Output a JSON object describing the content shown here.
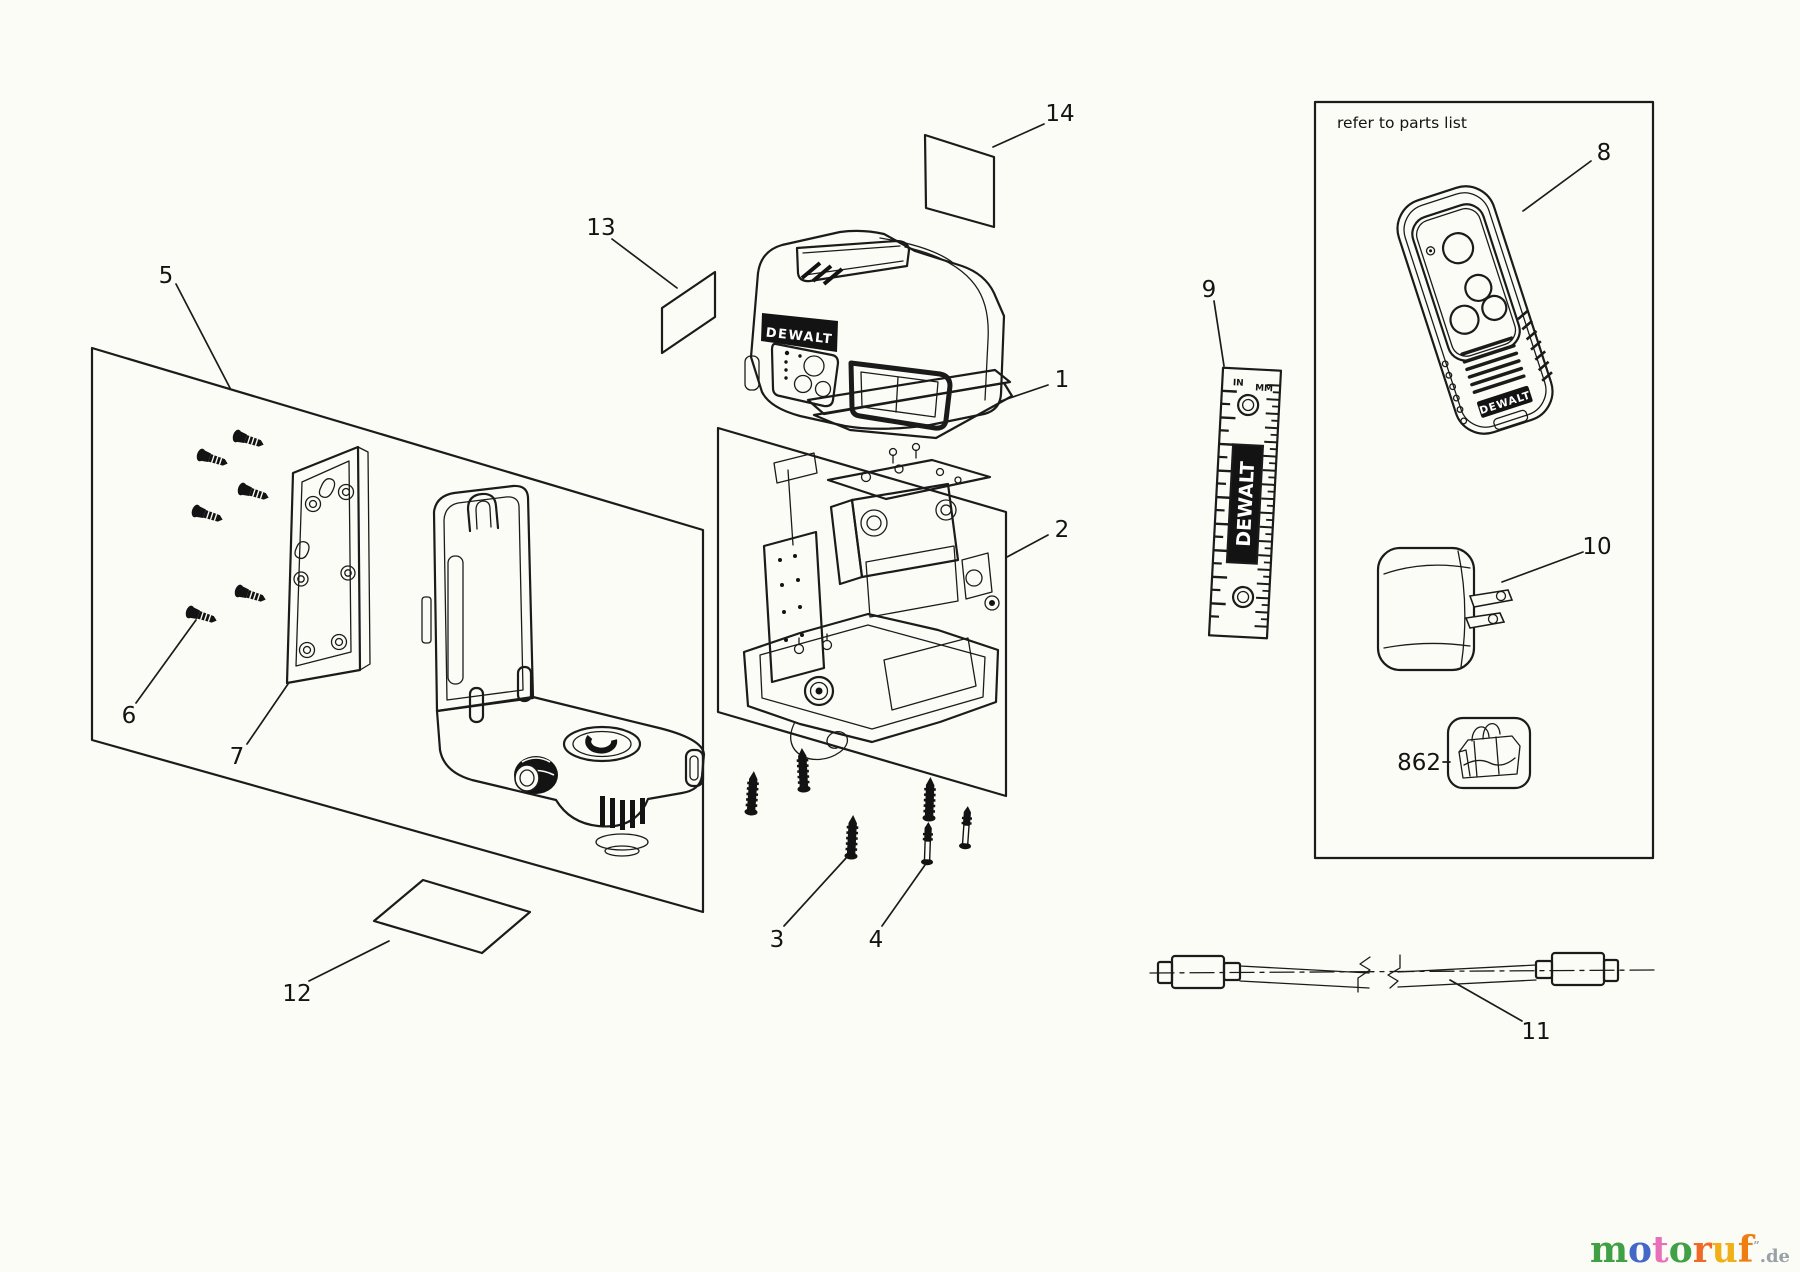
{
  "canvas": {
    "width": 1800,
    "height": 1272,
    "background": "#fcfcf6",
    "line_color": "#1b1b1b"
  },
  "brand": {
    "name": "DEWALT"
  },
  "parts_box": {
    "note": "refer to parts list"
  },
  "ruler": {
    "unit_left": "IN",
    "unit_right": "MM"
  },
  "callouts": {
    "c1": {
      "label": "1"
    },
    "c2": {
      "label": "2"
    },
    "c3": {
      "label": "3"
    },
    "c4": {
      "label": "4"
    },
    "c5": {
      "label": "5"
    },
    "c6": {
      "label": "6"
    },
    "c7": {
      "label": "7"
    },
    "c8": {
      "label": "8"
    },
    "c9": {
      "label": "9"
    },
    "c10": {
      "label": "10"
    },
    "c11": {
      "label": "11"
    },
    "c12": {
      "label": "12"
    },
    "c13": {
      "label": "13"
    },
    "c14": {
      "label": "14"
    },
    "c862": {
      "label": "862"
    }
  },
  "watermark": {
    "letters": [
      {
        "ch": "m",
        "color": "#3fa045"
      },
      {
        "ch": "o",
        "color": "#4468c8"
      },
      {
        "ch": "t",
        "color": "#e870b8"
      },
      {
        "ch": "o",
        "color": "#3fa045"
      },
      {
        "ch": "r",
        "color": "#ef6a28"
      },
      {
        "ch": "u",
        "color": "#f0b019"
      },
      {
        "ch": "f",
        "color": "#ef7d12"
      }
    ],
    "mark": "”",
    "suffix": ".de"
  }
}
